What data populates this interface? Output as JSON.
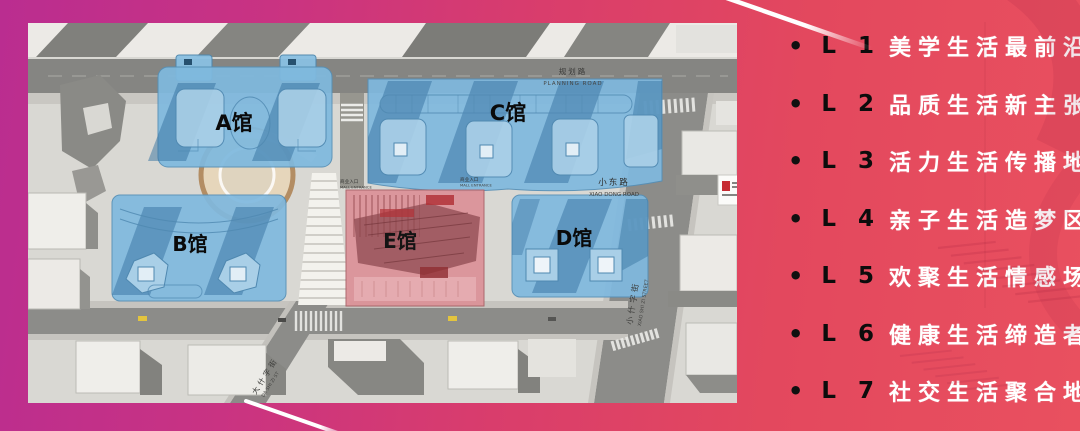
{
  "right_panel": {
    "bullet": "•",
    "items": [
      {
        "level": "L 1",
        "desc": "美学生活最前沿"
      },
      {
        "level": "L 2",
        "desc": "品质生活新主张"
      },
      {
        "level": "L 3",
        "desc": "活力生活传播地"
      },
      {
        "level": "L 4",
        "desc": "亲子生活造梦区"
      },
      {
        "level": "L 5",
        "desc": "欢聚生活情感场"
      },
      {
        "level": "L 6",
        "desc": "健康生活缔造者"
      },
      {
        "level": "L 7",
        "desc": "社交生活聚合地"
      }
    ]
  },
  "map": {
    "halls": [
      {
        "key": "a",
        "label": "A馆"
      },
      {
        "key": "b",
        "label": "B馆"
      },
      {
        "key": "c",
        "label": "C馆"
      },
      {
        "key": "d",
        "label": "D馆"
      },
      {
        "key": "e",
        "label": "E馆"
      }
    ],
    "roads": {
      "planning_cn": "规划路",
      "planning_en": "PLANNING ROAD",
      "xiaodong_cn": "小东路",
      "xiaodong_en": "XIAO DONG ROAD",
      "xiaoshizi_cn": "小什字街",
      "xiaoshizi_en": "XIAO SHI ZI STREET",
      "dashizi_cn": "大什字街",
      "dashizi_en": "DA SHI ZI ST"
    },
    "entrance": {
      "cn": "商业入口",
      "en": "MALL ENTRANCE"
    }
  },
  "colors": {
    "bg_left_magenta": "#ba2d90",
    "bg_right_coral": "#e9505f",
    "hall_blue": "#7fb9de",
    "hall_red": "#db9298",
    "list_text": "#ffffff",
    "list_level": "#0c0c0c"
  }
}
